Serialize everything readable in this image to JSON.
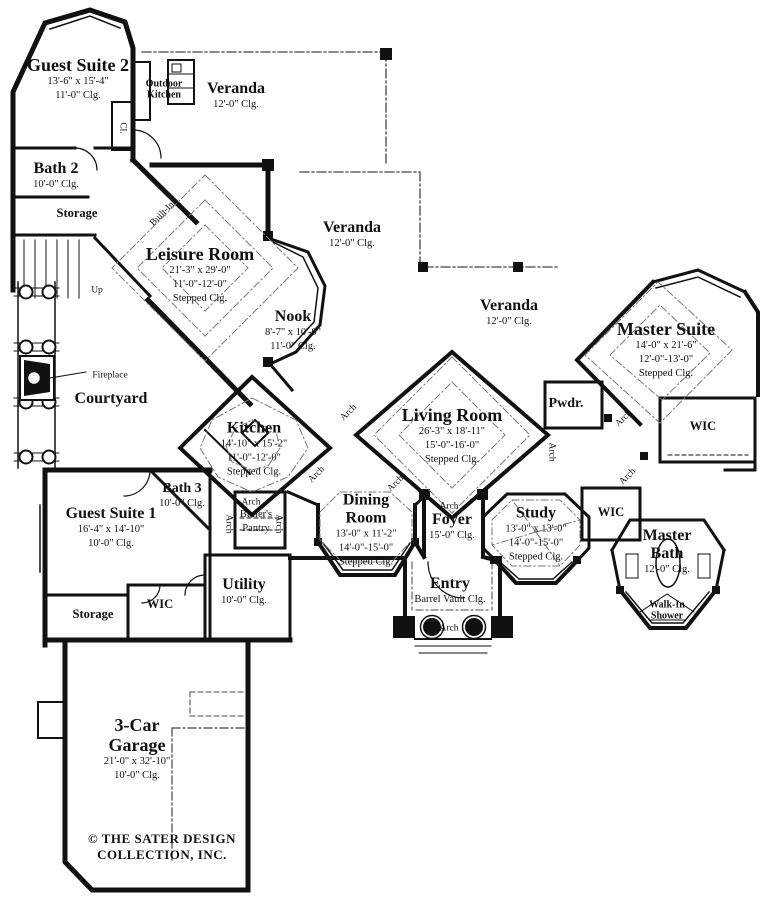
{
  "colors": {
    "wall": "#111111",
    "background": "#ffffff",
    "ceiling_dash": "#777777"
  },
  "labels": {
    "arch": "Arch",
    "wic": "WIC",
    "up": "Up",
    "cl": "Cl.",
    "storage": "Storage",
    "built_ins": "Built-Ins",
    "fireplace": "Fireplace",
    "outdoor_kitchen_l1": "Outdoor",
    "outdoor_kitchen_l2": "Kitchen"
  },
  "rooms": {
    "guest_suite_2": {
      "name": "Guest Suite 2",
      "dim": "13'-6\" x 15'-4\"",
      "clg": "11'-0\" Clg."
    },
    "veranda_top": {
      "name": "Veranda",
      "clg": "12'-0\" Clg."
    },
    "bath_2": {
      "name": "Bath 2",
      "clg": "10'-0\" Clg."
    },
    "leisure_room": {
      "name": "Leisure Room",
      "dim": "21'-3\" x 29'-0\"",
      "clg1": "11'-0\"-12'-0\"",
      "clg2": "Stepped Clg."
    },
    "veranda_mid": {
      "name": "Veranda",
      "clg": "12'-0\" Clg."
    },
    "nook": {
      "name": "Nook",
      "dim": "8'-7\" x 10'-0\"",
      "clg": "11'-0\" Clg."
    },
    "veranda_right": {
      "name": "Veranda",
      "clg": "12'-0\" Clg."
    },
    "master_suite": {
      "name": "Master Suite",
      "dim": "14'-0\" x 21'-6\"",
      "clg1": "12'-0\"-13'-0\"",
      "clg2": "Stepped Clg."
    },
    "courtyard": {
      "name": "Courtyard"
    },
    "kitchen": {
      "name": "Kitchen",
      "dim": "14'-10\" x 15'-2\"",
      "clg1": "11'-0\"-12'-0\"",
      "clg2": "Stepped Clg."
    },
    "living_room": {
      "name": "Living Room",
      "dim": "26'-3\" x 18'-11\"",
      "clg1": "15'-0\"-16'-0\"",
      "clg2": "Stepped Clg."
    },
    "pwdr": {
      "name": "Pwdr."
    },
    "guest_suite_1": {
      "name": "Guest Suite 1",
      "dim": "16'-4\" x 14'-10\"",
      "clg": "10'-0\" Clg."
    },
    "bath_3": {
      "name": "Bath 3",
      "clg": "10'-0\" Clg."
    },
    "butlers_pantry": {
      "name_l1": "Butler's",
      "name_l2": "Pantry"
    },
    "dining_room": {
      "name_l1": "Dining",
      "name_l2": "Room",
      "dim": "13'-0\" x 11'-2\"",
      "clg1": "14'-0\"-15'-0\"",
      "clg2": "Stepped Clg."
    },
    "foyer": {
      "name": "Foyer",
      "clg": "15'-0\" Clg."
    },
    "study": {
      "name": "Study",
      "dim": "13'-0\" x 13'-0\"",
      "clg1": "14'-0\"-15'-0\"",
      "clg2": "Stepped Clg."
    },
    "entry": {
      "name": "Entry",
      "clg": "Barrel Vault Clg."
    },
    "master_bath": {
      "name_l1": "Master",
      "name_l2": "Bath",
      "clg": "12'-0\" Clg."
    },
    "walk_in_shower": {
      "name_l1": "Walk-In",
      "name_l2": "Shower"
    },
    "utility": {
      "name": "Utility",
      "clg": "10'-0\" Clg."
    },
    "garage": {
      "name_l1": "3-Car",
      "name_l2": "Garage",
      "dim": "21'-0\" x 32'-10\"",
      "clg": "10'-0\" Clg."
    }
  },
  "copyright": {
    "line1": "© THE SATER DESIGN",
    "line2": "COLLECTION, INC."
  }
}
